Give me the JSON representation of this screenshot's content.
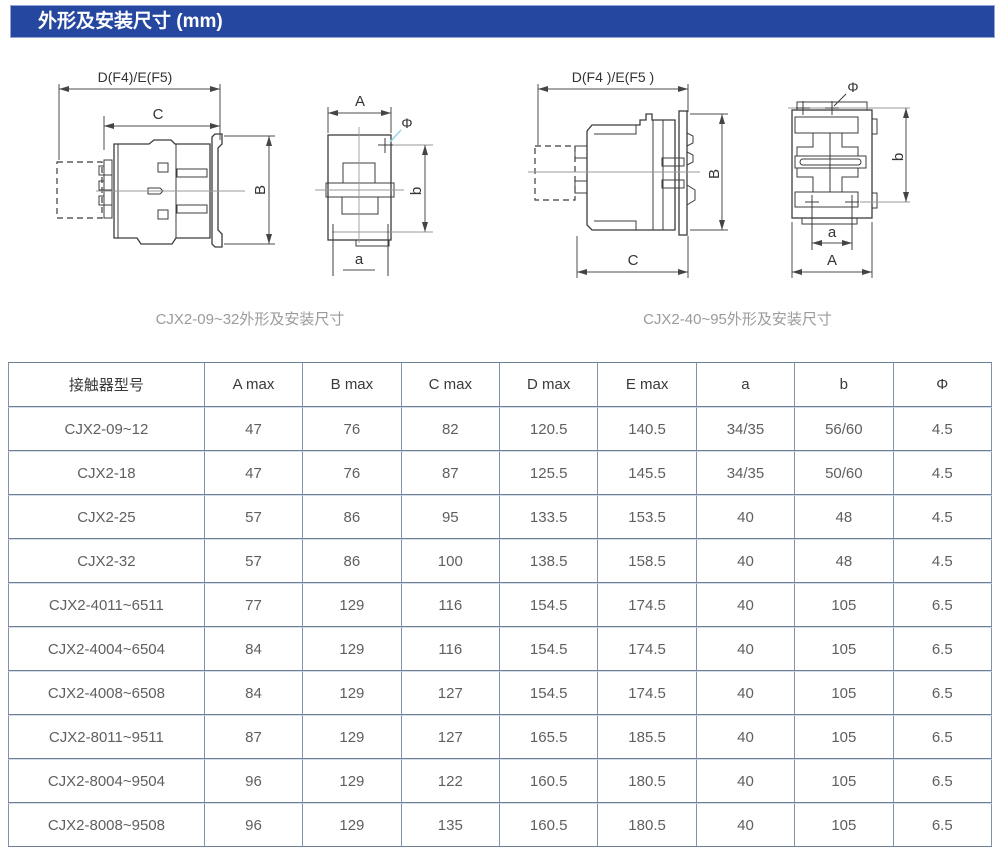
{
  "section_header": {
    "title": "外形及安装尺寸 (mm)"
  },
  "colors": {
    "header_bg": "#2547a0",
    "header_text": "#ffffff",
    "table_border_dark": "#6c7f97",
    "table_border_light": "#d4dde8",
    "table_border_vertical": "#8093aa",
    "leader_blue": "#8fd4e4",
    "drawing_line": "#3c3c3c",
    "caption_text": "#9b9b9b"
  },
  "figures": [
    {
      "caption": "CJX2-09~32外形及安装尺寸",
      "labels": {
        "width_dim": "D(F4)/E(F5)",
        "depth_dim": "C",
        "height_dim": "B",
        "front_width_dim": "A",
        "hole_dia": "Φ",
        "hole_height_dim": "b",
        "hole_width_dim": "a"
      }
    },
    {
      "caption": "CJX2-40~95外形及安装尺寸",
      "labels": {
        "width_dim": "D(F4 )/E(F5 )",
        "depth_dim": "C",
        "height_dim": "B",
        "front_width_dim": "A",
        "hole_dia": "Φ",
        "hole_height_dim": "b",
        "hole_width_dim": "a"
      }
    }
  ],
  "table": {
    "columns": [
      "接触器型号",
      "A max",
      "B max",
      "C max",
      "D max",
      "E max",
      "a",
      "b",
      "Φ"
    ],
    "rows": [
      [
        "CJX2-09~12",
        "47",
        "76",
        "82",
        "120.5",
        "140.5",
        "34/35",
        "56/60",
        "4.5"
      ],
      [
        "CJX2-18",
        "47",
        "76",
        "87",
        "125.5",
        "145.5",
        "34/35",
        "50/60",
        "4.5"
      ],
      [
        "CJX2-25",
        "57",
        "86",
        "95",
        "133.5",
        "153.5",
        "40",
        "48",
        "4.5"
      ],
      [
        "CJX2-32",
        "57",
        "86",
        "100",
        "138.5",
        "158.5",
        "40",
        "48",
        "4.5"
      ],
      [
        "CJX2-4011~6511",
        "77",
        "129",
        "116",
        "154.5",
        "174.5",
        "40",
        "105",
        "6.5"
      ],
      [
        "CJX2-4004~6504",
        "84",
        "129",
        "116",
        "154.5",
        "174.5",
        "40",
        "105",
        "6.5"
      ],
      [
        "CJX2-4008~6508",
        "84",
        "129",
        "127",
        "154.5",
        "174.5",
        "40",
        "105",
        "6.5"
      ],
      [
        "CJX2-8011~9511",
        "87",
        "129",
        "127",
        "165.5",
        "185.5",
        "40",
        "105",
        "6.5"
      ],
      [
        "CJX2-8004~9504",
        "96",
        "129",
        "122",
        "160.5",
        "180.5",
        "40",
        "105",
        "6.5"
      ],
      [
        "CJX2-8008~9508",
        "96",
        "129",
        "135",
        "160.5",
        "180.5",
        "40",
        "105",
        "6.5"
      ]
    ]
  }
}
